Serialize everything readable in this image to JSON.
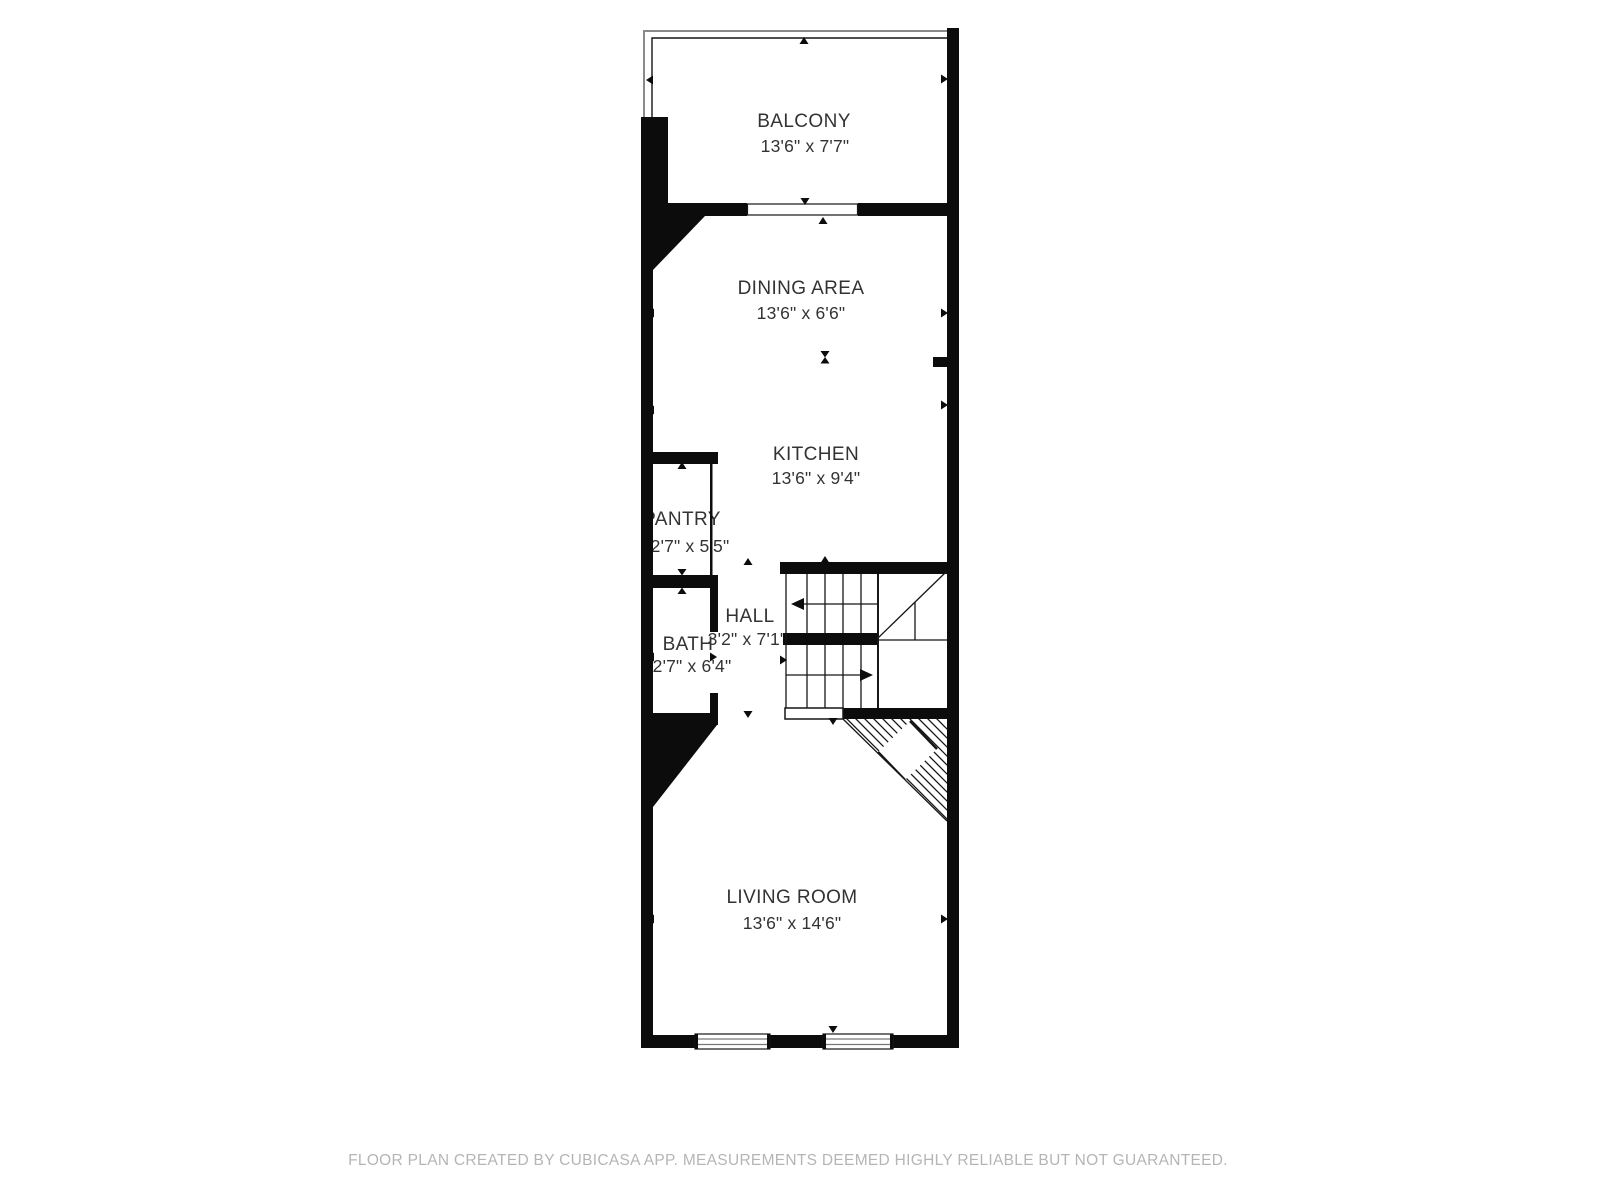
{
  "plan": {
    "rooms": [
      {
        "id": "balcony",
        "name": "BALCONY",
        "dims": "13'6\" x 7'7\""
      },
      {
        "id": "dining",
        "name": "DINING AREA",
        "dims": "13'6\" x 6'6\""
      },
      {
        "id": "kitchen",
        "name": "KITCHEN",
        "dims": "13'6\" x 9'4\""
      },
      {
        "id": "pantry",
        "name": "PANTRY",
        "dims": "2'7\" x 5'5\""
      },
      {
        "id": "hall",
        "name": "HALL",
        "dims": "3'2\" x 7'1\""
      },
      {
        "id": "bath",
        "name": "BATH",
        "dims": "2'7\" x 6'4\""
      },
      {
        "id": "living",
        "name": "LIVING ROOM",
        "dims": "13'6\" x 14'6\""
      }
    ],
    "footer": "FLOOR PLAN CREATED BY CUBICASA APP. MEASUREMENTS DEEMED HIGHLY RELIABLE BUT NOT GUARANTEED.",
    "colors": {
      "wall": "#0c0c0c",
      "label": "#333333",
      "footer": "#b5b5b5",
      "railing": "#8a8a8a"
    }
  }
}
